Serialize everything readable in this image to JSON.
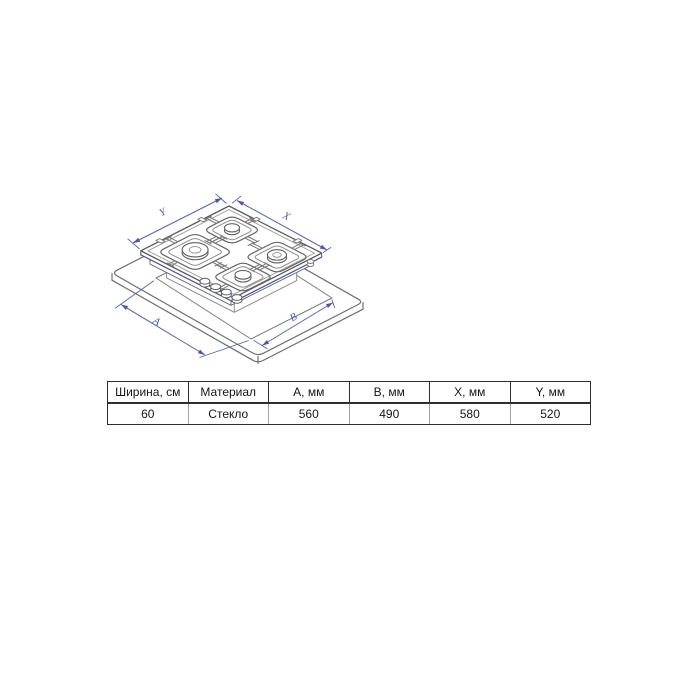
{
  "diagram": {
    "description": "Isometric technical line drawing of a 4-burner gas hob floating above a countertop with rectangular cutout",
    "labels": {
      "y": "Y",
      "x": "X",
      "a": "A",
      "b": "B"
    },
    "colors": {
      "dimension_blue": "#5563ab",
      "arrow_blue": "#4a59a6",
      "glass_edge_blue": "#4a58a0",
      "line_gray": "#5f5f5f",
      "light_gray": "#8c8c8c"
    }
  },
  "table": {
    "headers": [
      "Ширина, см",
      "Материал",
      "A, мм",
      "B, мм",
      "X, мм",
      "Y, мм"
    ],
    "rows": [
      [
        "60",
        "Стекло",
        "560",
        "490",
        "580",
        "520"
      ]
    ]
  }
}
